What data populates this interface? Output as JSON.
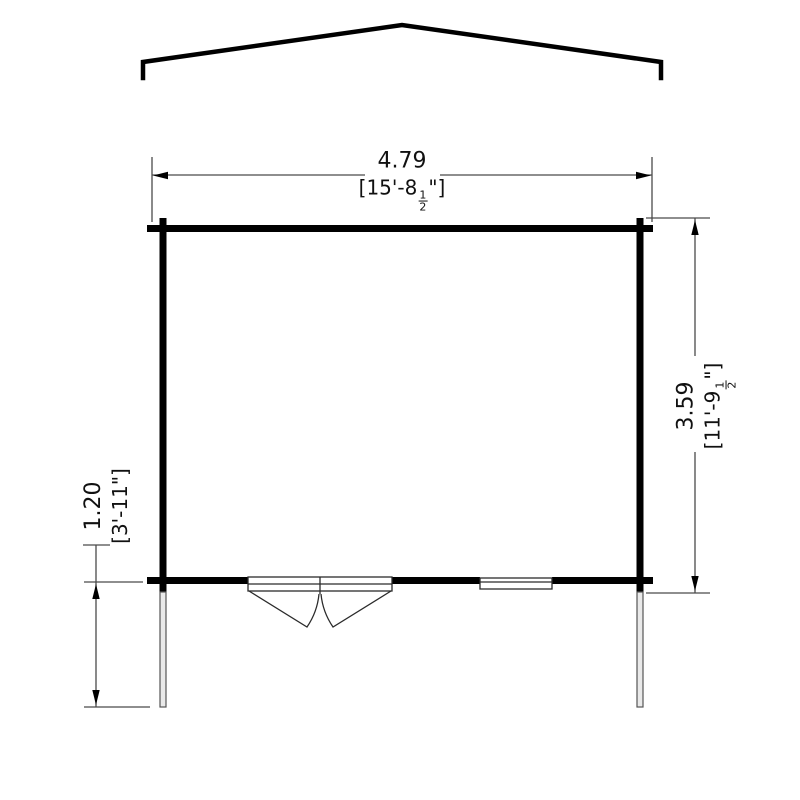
{
  "diagram": {
    "type": "floor-plan-dimension-drawing",
    "background": "#ffffff",
    "wall_color": "#000000",
    "dim_line_color": "#4a4a4a",
    "thin_line_color": "#6e6e6e",
    "post_fill": "#e9e9e9",
    "dimensions": {
      "width": {
        "metric": "4.79",
        "imperial_prefix": "[15'-8",
        "fraction_numerator": "1",
        "fraction_denominator": "2",
        "imperial_suffix": "\"]"
      },
      "depth": {
        "metric": "3.59",
        "imperial_prefix": "[11'-9",
        "fraction_numerator": "1",
        "fraction_denominator": "2",
        "imperial_suffix": "\"]"
      },
      "canopy_depth": {
        "metric": "1.20",
        "imperial": "[3'-11\"]"
      }
    },
    "features": {
      "roof": "gable-roof-profile",
      "door": "double-door-outward-swing",
      "window": "front-window",
      "posts": "two-veranda-posts"
    }
  }
}
